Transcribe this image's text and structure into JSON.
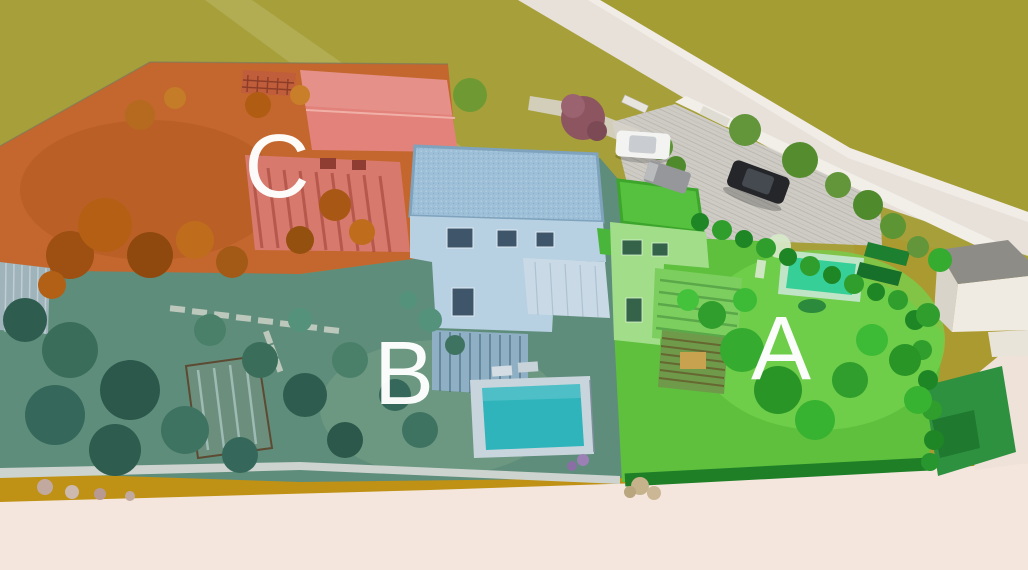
{
  "scene": {
    "name": "aerial-3d-site-plan-render",
    "description": "Aerial 3D rendering of a residential development with three color-highlighted units"
  },
  "zones": {
    "a": {
      "label": "A",
      "label_color": "#ffffff",
      "ground_color": "#5ec03d",
      "lawn_highlight_color": "#74d14e",
      "hedge_color": "#1e7f26",
      "house_roof_color": "#55c13e",
      "house_wall_color": "#a2de8a",
      "pool_water_color": "#36cf97",
      "pool_deck_color": "#bfe4c6",
      "shed_color": "#2e9140"
    },
    "b": {
      "label": "B",
      "label_color": "#ffffff",
      "ground_color": "#5f8d7b",
      "lawn_highlight_color": "#6f9b84",
      "house_roof_color": "#9dbfd7",
      "house_wall_color": "#b7d0e2",
      "terrace_color": "#c9dae6",
      "pool_water_color": "#2fb4bc",
      "pool_deck_color": "#c9d5dc",
      "greenhouse_color": "#6b8f7c",
      "shed_color": "#9fb3ba"
    },
    "c": {
      "label": "C",
      "label_color": "#ffffff",
      "ground_color": "#c4672e",
      "house_roof_color": "#e2827a",
      "house_wall_color": "#d8796d",
      "trellis_color": "#c05d3a"
    }
  },
  "environment": {
    "field_color": "#a7a03a",
    "field_margin_color": "#bf9114",
    "field_right_color": "#ab9a2f",
    "upper_road_color": "#e7e1da",
    "lower_road_color": "#f4e6dd",
    "right_road_color": "#efe2d8",
    "boundary_wall_color": "#f2eee8",
    "parking_color": "#cecbc5",
    "garden_wall_color": "#cdd3cf",
    "neighbor_building_wall_color": "#efeae2",
    "neighbor_building_roof_color": "#8e8c87"
  },
  "vehicles": {
    "white_car_color": "#f3f3f1",
    "van_color": "#95979a",
    "black_car_color": "#24262a"
  }
}
